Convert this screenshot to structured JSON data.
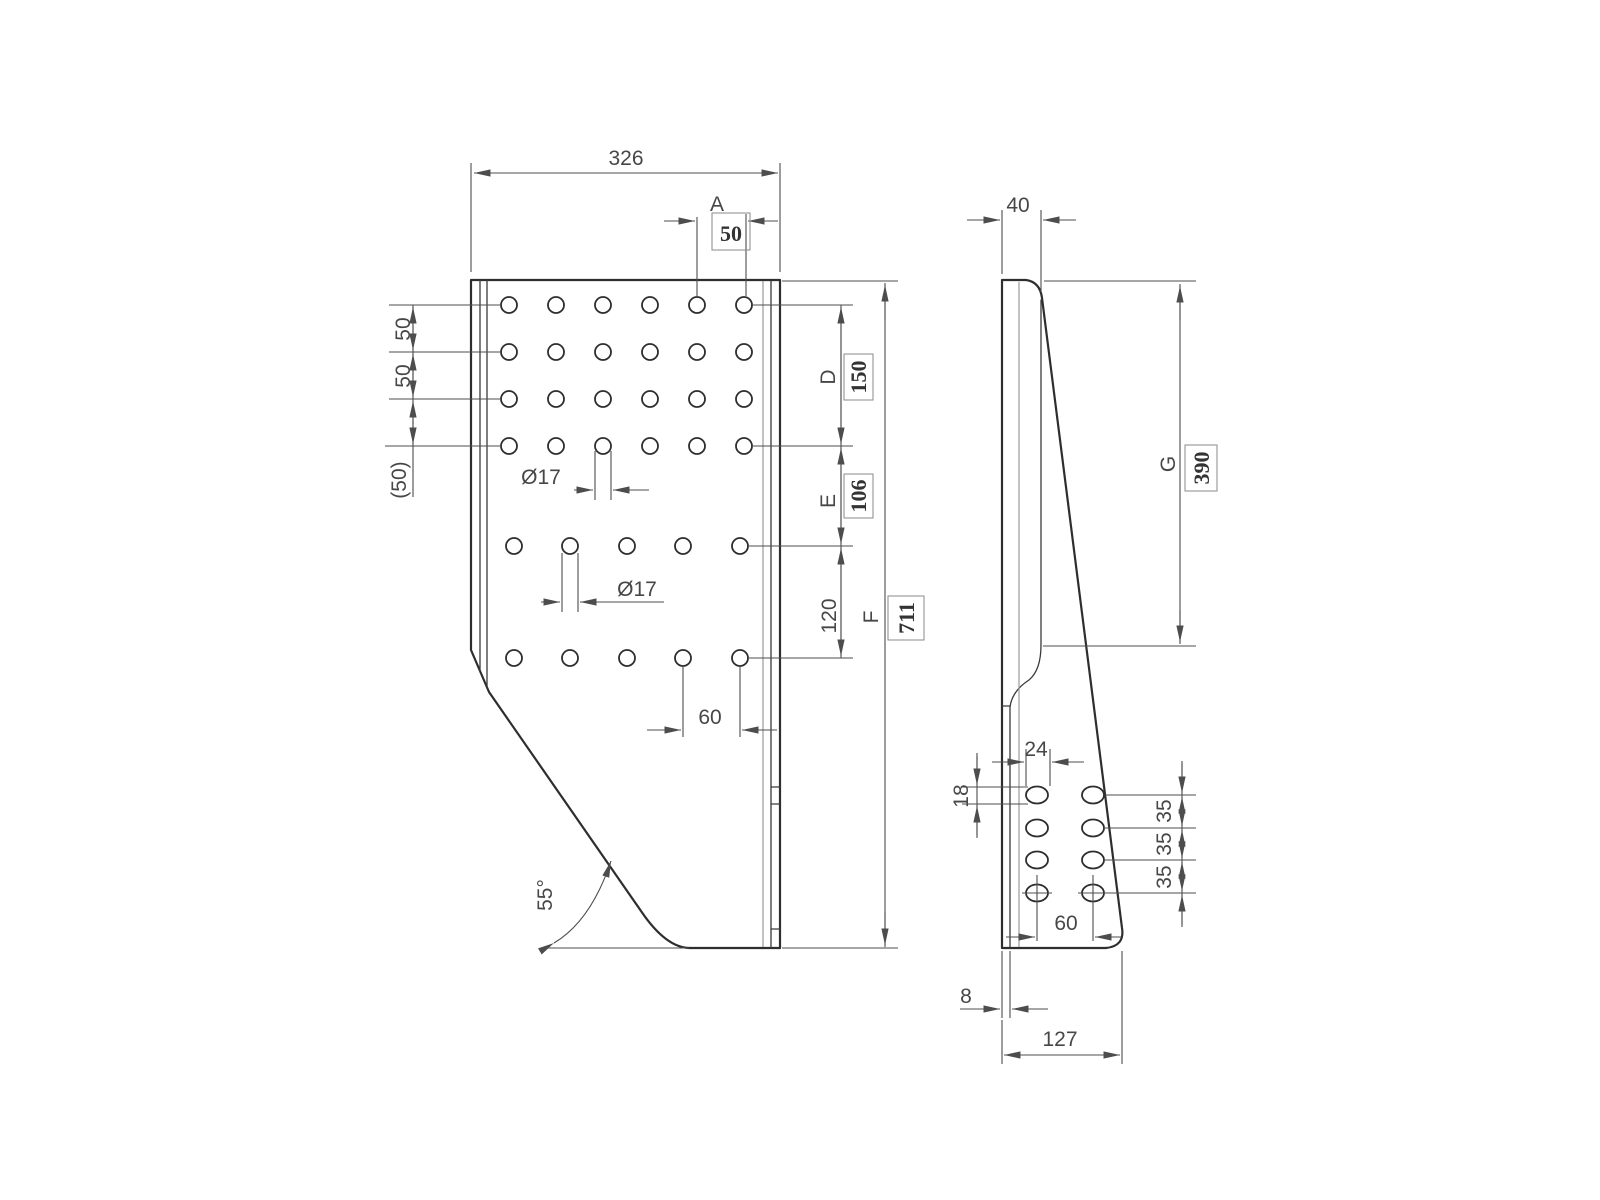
{
  "drawing": {
    "background": "#ffffff",
    "line_color": "#2e2e2e",
    "dim_color": "#4d4d4d"
  },
  "front_view": {
    "overall_width": "326",
    "hole_spacing_a_label": "A",
    "hole_spacing_a_value": "50",
    "row_pitches": [
      "50",
      "50",
      "(50)"
    ],
    "hole_dia_top": "Ø17",
    "hole_dia_mid": "Ø17",
    "col_pitch_bottom": "60",
    "seg_d_label": "D",
    "seg_d_value": "150",
    "seg_e_label": "E",
    "seg_e_value": "106",
    "seg_120": "120",
    "overall_height_label": "F",
    "overall_height_value": "711",
    "bend_angle": "55°"
  },
  "side_view": {
    "depth_top": "40",
    "seg_g_label": "G",
    "seg_g_value": "390",
    "slot_width": "24",
    "slot_height": "18",
    "slot_pitches": [
      "35",
      "35",
      "35"
    ],
    "slot_col_pitch": "60",
    "plate_thickness": "8",
    "bottom_width": "127"
  }
}
